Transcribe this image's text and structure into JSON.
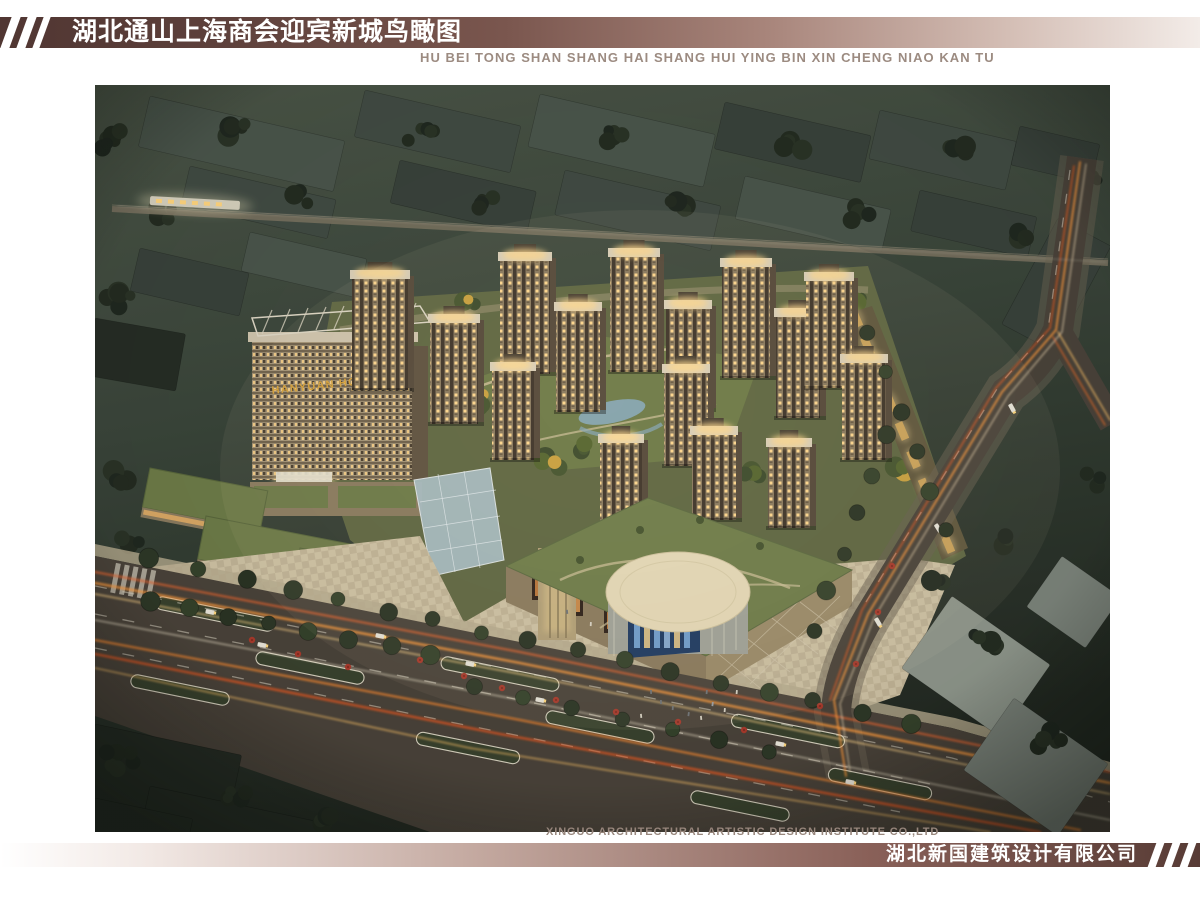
{
  "header": {
    "title_cn": "湖北通山上海商会迎宾新城鸟瞰图",
    "title_pinyin": "HU BEI TONG SHAN SHANG HAI SHANG HUI YING BIN XIN CHENG NIAO KAN TU"
  },
  "footer": {
    "company_en": "XINGUO ARCHITECTURAL ARTISTIC DESIGN INSTITUTE CO.,LTD",
    "company_cn": "湖北新国建筑设计有限公司"
  },
  "rendering": {
    "hotel_sign": "HANYUAN HOTEL",
    "subject": "night aerial bird's-eye view of Yingbin New City mixed-use development"
  },
  "palette": {
    "brand_maroon": "#5d3f38",
    "band_light": "#f3ece8",
    "caption_gray": "#97867c",
    "gold_sign": "#d8a33c",
    "night_ground": "#3a453a",
    "road": "#4a433a",
    "trail_orange": "#ff9b3d",
    "lawn_green": "#6d7a47",
    "roof_green": "#6f7d4a",
    "facade_tan": "#8a7a5f",
    "window_glow": "#ffd88f",
    "paving": "#cdc2a4"
  },
  "scene": {
    "palette": {
      "g1": "#4a554b",
      "g2": "#414b43",
      "g3": "#39423b",
      "g4": "#262d25",
      "gr1": "#8e968b",
      "gr2": "#7b837a"
    },
    "blocks": [
      [
        150,
        96,
        200,
        52,
        13,
        "g1"
      ],
      [
        365,
        90,
        160,
        48,
        13,
        "g2"
      ],
      [
        540,
        94,
        180,
        54,
        13,
        "g1"
      ],
      [
        725,
        102,
        150,
        48,
        13,
        "g3"
      ],
      [
        880,
        110,
        140,
        50,
        13,
        "g2"
      ],
      [
        1020,
        126,
        82,
        40,
        13,
        "g3"
      ],
      [
        190,
        166,
        150,
        40,
        13,
        "g2"
      ],
      [
        400,
        160,
        140,
        44,
        13,
        "g3"
      ],
      [
        565,
        170,
        160,
        46,
        13,
        "g2"
      ],
      [
        745,
        176,
        150,
        44,
        13,
        "g1"
      ],
      [
        920,
        190,
        120,
        42,
        13,
        "g3"
      ],
      [
        140,
        248,
        112,
        44,
        13,
        "g3"
      ],
      [
        250,
        232,
        120,
        40,
        13,
        "g1"
      ],
      [
        95,
        318,
        92,
        58,
        10,
        "g4"
      ],
      [
        1058,
        218,
        60,
        120,
        28,
        "g3"
      ],
      [
        95,
        724,
        150,
        82,
        12,
        "g4",
        "fg"
      ],
      [
        150,
        786,
        175,
        60,
        12,
        "g4",
        "fg"
      ],
      [
        95,
        798,
        100,
        44,
        12,
        "g4",
        "fg"
      ],
      [
        952,
        596,
        120,
        88,
        35,
        "gr1",
        "fg"
      ],
      [
        1014,
        698,
        115,
        88,
        35,
        "gr2",
        "fg"
      ],
      [
        1062,
        556,
        72,
        62,
        35,
        "gr2",
        "fg"
      ]
    ],
    "towers": [
      [
        352,
        268,
        56,
        122
      ],
      [
        430,
        312,
        48,
        112
      ],
      [
        500,
        250,
        50,
        124
      ],
      [
        556,
        300,
        44,
        112
      ],
      [
        610,
        246,
        48,
        126
      ],
      [
        666,
        298,
        44,
        112
      ],
      [
        722,
        256,
        48,
        122
      ],
      [
        776,
        306,
        44,
        112
      ],
      [
        806,
        270,
        46,
        118
      ],
      [
        842,
        352,
        44,
        108
      ],
      [
        492,
        360,
        42,
        100
      ],
      [
        664,
        362,
        44,
        104
      ],
      [
        600,
        432,
        42,
        94
      ],
      [
        692,
        424,
        44,
        96
      ],
      [
        768,
        436,
        42,
        92
      ]
    ],
    "medians": [
      [
        215,
        614,
        120
      ],
      [
        500,
        674,
        120
      ],
      [
        788,
        731,
        115
      ],
      [
        310,
        668,
        110
      ],
      [
        600,
        727,
        110
      ],
      [
        880,
        784,
        105
      ],
      [
        180,
        690,
        100
      ],
      [
        468,
        748,
        105
      ],
      [
        740,
        806,
        100
      ]
    ],
    "trails": [
      [
        "95,572 520,652 1110,772",
        "#e8652e",
        2,
        0.8
      ],
      [
        "95,583 520,663 1110,783",
        "#ff9b3d",
        2.4,
        0.85
      ],
      [
        "95,594 520,674 1110,794",
        "#ffd489",
        1.4,
        0.8
      ],
      [
        "95,620 520,700 1110,820",
        "#fff3d8",
        1.2,
        0.7
      ],
      [
        "95,640 520,720 1080,830",
        "#ff8c2e",
        2,
        0.8
      ],
      [
        "95,654 500,734 1040,832",
        "#e8581f",
        2.4,
        0.8
      ],
      [
        "95,668 470,748 990,832",
        "#ffc46a",
        1.4,
        0.75
      ],
      [
        "1080,162 1056,330 1002,392 868,614 834,700 846,776",
        "#ff9b3d",
        1.8,
        0.85
      ],
      [
        "1086,164 1062,332 1008,396 874,618 840,704 850,772",
        "#ffe8bf",
        1,
        0.8
      ],
      [
        "1074,166 1050,328 996,388 862,610 830,700",
        "#e05a20",
        1.6,
        0.8
      ],
      [
        "1058,332 1110,420",
        "#ffc46a",
        1.4,
        0.8
      ],
      [
        "1053,337 1105,425",
        "#e86a28",
        1.4,
        0.8
      ],
      [
        "118,206 1106,262",
        "#c9c2ae",
        1,
        0.35
      ]
    ],
    "tree_rows": [
      [
        150,
        560,
        910,
        722,
        17,
        8
      ],
      [
        888,
        436,
        812,
        630,
        6,
        8
      ],
      [
        868,
        332,
        948,
        530,
        6,
        7
      ],
      [
        475,
        688,
        770,
        752,
        7,
        8
      ],
      [
        150,
        600,
        430,
        654,
        8,
        8
      ]
    ],
    "tree_clusters_bg": [
      [
        115,
        140,
        6,
        30
      ],
      [
        240,
        128,
        5,
        26
      ],
      [
        420,
        132,
        5,
        28
      ],
      [
        610,
        138,
        5,
        26
      ],
      [
        790,
        142,
        5,
        26
      ],
      [
        960,
        150,
        4,
        22
      ],
      [
        120,
        300,
        5,
        26
      ],
      [
        165,
        214,
        4,
        20
      ],
      [
        300,
        198,
        4,
        22
      ],
      [
        490,
        204,
        4,
        22
      ],
      [
        680,
        208,
        4,
        22
      ],
      [
        860,
        214,
        4,
        22
      ],
      [
        1020,
        232,
        4,
        20
      ],
      [
        115,
        478,
        4,
        24
      ],
      [
        130,
        540,
        3,
        18
      ],
      [
        1090,
        180,
        3,
        16
      ]
    ],
    "tree_clusters_fg": [
      [
        120,
        760,
        6,
        32
      ],
      [
        235,
        800,
        5,
        26
      ],
      [
        330,
        820,
        4,
        20
      ],
      [
        985,
        640,
        5,
        26
      ],
      [
        1048,
        738,
        5,
        28
      ],
      [
        938,
        582,
        4,
        18
      ],
      [
        1092,
        480,
        4,
        20
      ],
      [
        1006,
        540,
        3,
        16
      ]
    ],
    "garden_trees": [
      [
        480,
        402,
        5,
        26
      ],
      [
        552,
        464,
        4,
        20
      ],
      [
        640,
        300,
        3,
        18
      ],
      [
        700,
        324,
        4,
        20
      ],
      [
        752,
        474,
        4,
        18
      ],
      [
        470,
        302,
        3,
        16
      ],
      [
        858,
        300,
        3,
        16
      ],
      [
        898,
        468,
        3,
        14
      ],
      [
        586,
        448,
        3,
        14
      ]
    ],
    "shops_line": {
      "x1": 856,
      "y1": 318,
      "x2": 948,
      "y2": 544,
      "count": 9
    },
    "umbrellas": [
      [
        252,
        640
      ],
      [
        298,
        654
      ],
      [
        348,
        667
      ],
      [
        420,
        660
      ],
      [
        464,
        676
      ],
      [
        502,
        688
      ],
      [
        556,
        700
      ],
      [
        616,
        712
      ],
      [
        678,
        722
      ],
      [
        744,
        730
      ],
      [
        820,
        706
      ],
      [
        856,
        664
      ],
      [
        878,
        612
      ],
      [
        892,
        566
      ]
    ],
    "people": [
      [
        660,
        700
      ],
      [
        672,
        706
      ],
      [
        688,
        712
      ],
      [
        700,
        716
      ],
      [
        712,
        702
      ],
      [
        650,
        690
      ],
      [
        724,
        708
      ],
      [
        590,
        622
      ],
      [
        566,
        610
      ],
      [
        736,
        690
      ],
      [
        640,
        714
      ],
      [
        706,
        690
      ]
    ],
    "cars": [
      [
        210,
        612,
        11
      ],
      [
        262,
        645,
        11
      ],
      [
        470,
        664,
        11
      ],
      [
        540,
        700,
        11
      ],
      [
        780,
        744,
        11
      ],
      [
        850,
        782,
        11
      ],
      [
        1012,
        408,
        62
      ],
      [
        938,
        528,
        58
      ],
      [
        878,
        622,
        60
      ],
      [
        380,
        636,
        11
      ]
    ]
  }
}
